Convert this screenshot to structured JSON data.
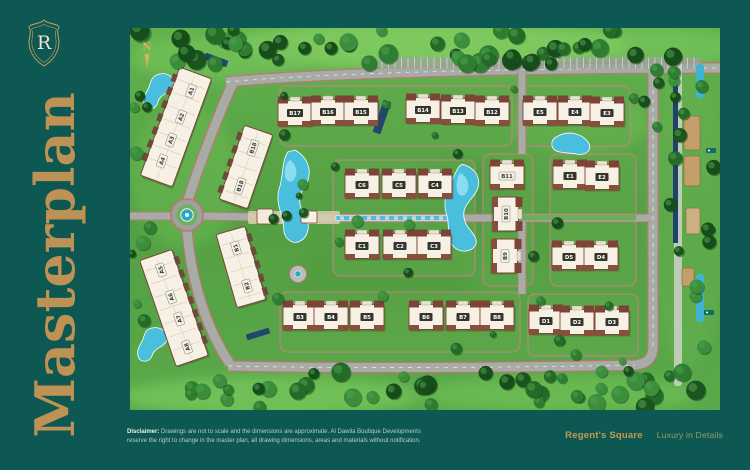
{
  "page": {
    "background": "#0d5852",
    "gold": "#bd9254"
  },
  "sidebar": {
    "logo_letter": "R",
    "title": "Masterplan"
  },
  "compass": {
    "label": "N"
  },
  "footer": {
    "disclaimer_label": "Disclaimer:",
    "disclaimer_line1": " Drawings are not to scale and the dimensions are approximate. Al Dawlia Boutique Developments",
    "disclaimer_line2": "reserve the right to change in the master plan, all drawing dimensions, areas and materials without notification.",
    "brand": "Regent's Square",
    "tagline": "Luxury in Details"
  },
  "masterplan": {
    "colors": {
      "grass": "#57a546",
      "road": "#a8aca7",
      "curb": "#c4737a",
      "water": "#49bedd",
      "roof": "#f6f1e4",
      "roof_trim": "#7c4336"
    },
    "buildings": [
      {
        "label": "A1",
        "x": 61,
        "y": 63,
        "rot": -70,
        "body": "none",
        "chip": "light"
      },
      {
        "label": "A2",
        "x": 51,
        "y": 89,
        "rot": -70,
        "body": "none",
        "chip": "light"
      },
      {
        "label": "A3",
        "x": 41,
        "y": 112,
        "rot": -70,
        "body": "none",
        "chip": "light"
      },
      {
        "label": "A4",
        "x": 32,
        "y": 133,
        "rot": -70,
        "body": "none",
        "chip": "light"
      },
      {
        "label": "A5",
        "x": 31,
        "y": 242,
        "rot": -109,
        "body": "none",
        "chip": "light"
      },
      {
        "label": "A6",
        "x": 41,
        "y": 269,
        "rot": -109,
        "body": "none",
        "chip": "light"
      },
      {
        "label": "A7",
        "x": 49,
        "y": 291,
        "rot": -109,
        "body": "none",
        "chip": "light"
      },
      {
        "label": "A8",
        "x": 57,
        "y": 319,
        "rot": -109,
        "body": "none",
        "chip": "light"
      },
      {
        "label": "B18",
        "x": 123,
        "y": 120,
        "rot": -71,
        "body": "none",
        "chip": "light"
      },
      {
        "label": "B18",
        "x": 110,
        "y": 158,
        "rot": -71,
        "body": "none",
        "chip": "light"
      },
      {
        "label": "B1",
        "x": 106,
        "y": 220,
        "rot": -106,
        "body": "none",
        "chip": "light"
      },
      {
        "label": "B2",
        "x": 117,
        "y": 258,
        "rot": -106,
        "body": "none",
        "chip": "light"
      },
      {
        "label": "B17",
        "x": 165,
        "y": 85,
        "rot": 0,
        "body": "std",
        "chip": "dark"
      },
      {
        "label": "B16",
        "x": 198,
        "y": 84,
        "rot": 0,
        "body": "std",
        "chip": "dark"
      },
      {
        "label": "B15",
        "x": 231,
        "y": 84,
        "rot": 0,
        "body": "std",
        "chip": "dark"
      },
      {
        "label": "B14",
        "x": 293,
        "y": 82,
        "rot": 0,
        "body": "std",
        "chip": "dark"
      },
      {
        "label": "B13",
        "x": 328,
        "y": 83,
        "rot": 0,
        "body": "std",
        "chip": "dark"
      },
      {
        "label": "B12",
        "x": 362,
        "y": 84,
        "rot": 0,
        "body": "std",
        "chip": "dark"
      },
      {
        "label": "E5",
        "x": 410,
        "y": 84,
        "rot": 0,
        "body": "std",
        "chip": "dark"
      },
      {
        "label": "E4",
        "x": 445,
        "y": 84,
        "rot": 0,
        "body": "std",
        "chip": "dark"
      },
      {
        "label": "E3",
        "x": 477,
        "y": 85,
        "rot": 0,
        "body": "std",
        "chip": "dark"
      },
      {
        "label": "C6",
        "x": 232,
        "y": 157,
        "rot": 0,
        "body": "std",
        "chip": "dark"
      },
      {
        "label": "C5",
        "x": 269,
        "y": 157,
        "rot": 0,
        "body": "std",
        "chip": "dark"
      },
      {
        "label": "C4",
        "x": 305,
        "y": 157,
        "rot": 0,
        "body": "std",
        "chip": "dark"
      },
      {
        "label": "C1",
        "x": 232,
        "y": 218,
        "rot": 0,
        "body": "std",
        "chip": "dark"
      },
      {
        "label": "C2",
        "x": 270,
        "y": 218,
        "rot": 0,
        "body": "std",
        "chip": "dark"
      },
      {
        "label": "C3",
        "x": 304,
        "y": 218,
        "rot": 0,
        "body": "std",
        "chip": "dark"
      },
      {
        "label": "B11",
        "x": 377,
        "y": 148,
        "rot": 0,
        "body": "std",
        "chip": "light"
      },
      {
        "label": "E1",
        "x": 440,
        "y": 148,
        "rot": 0,
        "body": "std",
        "chip": "dark"
      },
      {
        "label": "E2",
        "x": 472,
        "y": 149,
        "rot": 0,
        "body": "std",
        "chip": "dark"
      },
      {
        "label": "B10",
        "x": 376,
        "y": 186,
        "rot": -90,
        "body": "tall",
        "chip": "light"
      },
      {
        "label": "B9",
        "x": 375,
        "y": 228,
        "rot": -90,
        "body": "tall",
        "chip": "light"
      },
      {
        "label": "D5",
        "x": 439,
        "y": 229,
        "rot": 0,
        "body": "std",
        "chip": "dark"
      },
      {
        "label": "D4",
        "x": 471,
        "y": 229,
        "rot": 0,
        "body": "std",
        "chip": "dark"
      },
      {
        "label": "B3",
        "x": 170,
        "y": 289,
        "rot": 0,
        "body": "std",
        "chip": "dark"
      },
      {
        "label": "B4",
        "x": 201,
        "y": 289,
        "rot": 0,
        "body": "std",
        "chip": "dark"
      },
      {
        "label": "B5",
        "x": 237,
        "y": 289,
        "rot": 0,
        "body": "std",
        "chip": "dark"
      },
      {
        "label": "B6",
        "x": 296,
        "y": 289,
        "rot": 0,
        "body": "std",
        "chip": "dark"
      },
      {
        "label": "B7",
        "x": 333,
        "y": 289,
        "rot": 0,
        "body": "std",
        "chip": "dark"
      },
      {
        "label": "B8",
        "x": 367,
        "y": 289,
        "rot": 0,
        "body": "std",
        "chip": "dark"
      },
      {
        "label": "D1",
        "x": 416,
        "y": 293,
        "rot": 0,
        "body": "std",
        "chip": "dark"
      },
      {
        "label": "D2",
        "x": 447,
        "y": 294,
        "rot": 0,
        "body": "std",
        "chip": "dark"
      },
      {
        "label": "D3",
        "x": 482,
        "y": 294,
        "rot": 0,
        "body": "std",
        "chip": "dark"
      }
    ],
    "slabs": [
      {
        "x": 46,
        "y": 99,
        "w": 34,
        "h": 115,
        "rot": 20
      },
      {
        "x": 116,
        "y": 139,
        "w": 30,
        "h": 78,
        "rot": 19
      },
      {
        "x": 111,
        "y": 239,
        "w": 30,
        "h": 76,
        "rot": -16
      },
      {
        "x": 44,
        "y": 280,
        "w": 34,
        "h": 112,
        "rot": -19
      }
    ]
  }
}
